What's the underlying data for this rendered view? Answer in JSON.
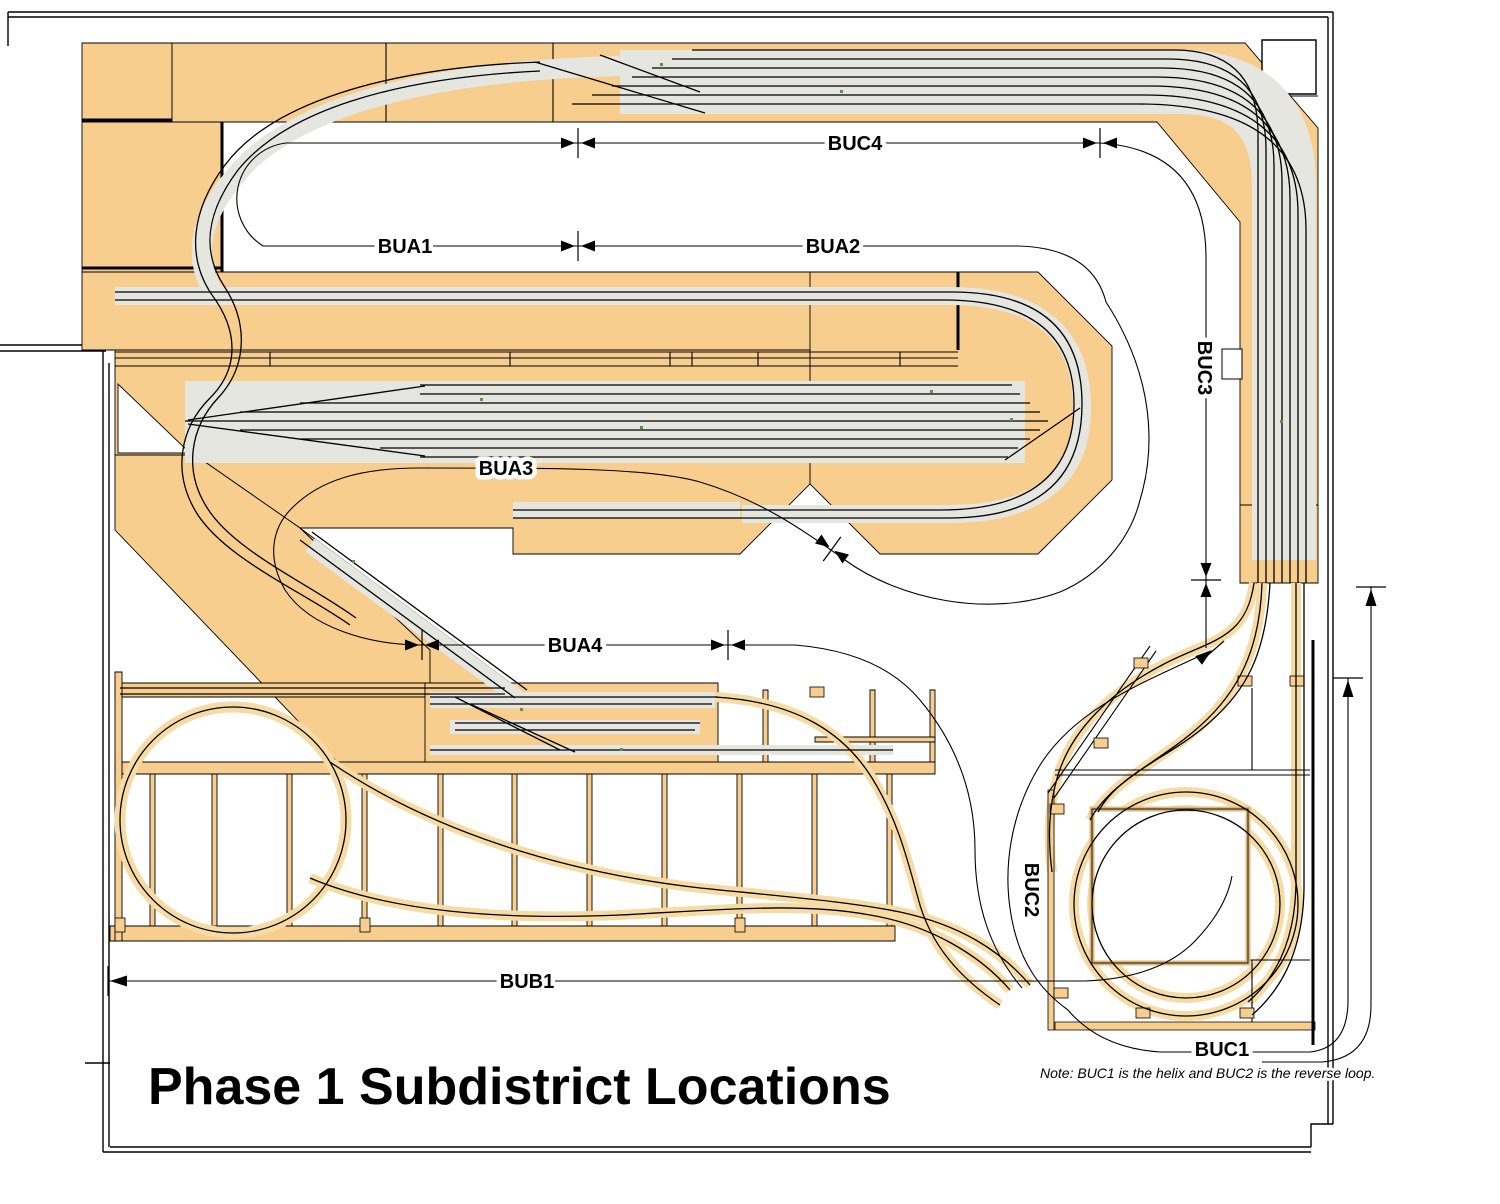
{
  "diagram": {
    "title": "Phase 1 Subdistrict Locations",
    "note": "Note: BUC1 is the helix and BUC2 is the reverse loop.",
    "labels": {
      "buc4": "BUC4",
      "bua1": "BUA1",
      "bua2": "BUA2",
      "bua3": "BUA3",
      "bua4": "BUA4",
      "bub1": "BUB1",
      "buc3": "BUC3",
      "buc2": "BUC2",
      "buc1": "BUC1"
    },
    "colors": {
      "benchwork": "#F8CE8F",
      "roadbed": "#E6E6E0",
      "hidden_track_halo": "#F6DCA4",
      "line": "#000000",
      "background": "#FFFFFF"
    }
  }
}
